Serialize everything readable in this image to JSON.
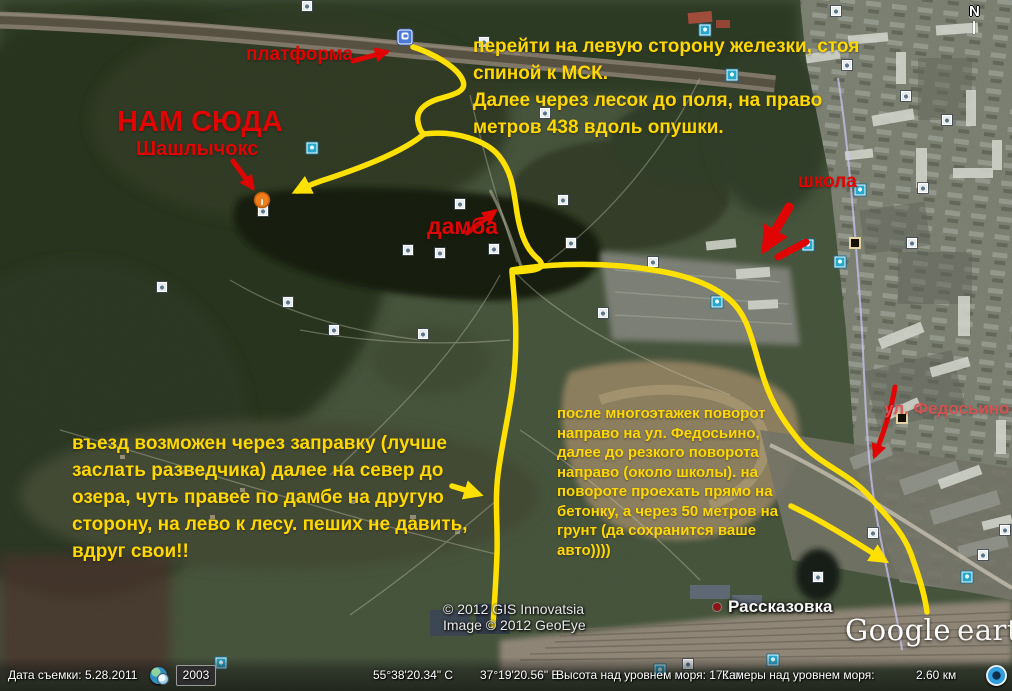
{
  "app": {
    "logo_google": "Google",
    "logo_earth": "earth",
    "compass_label": "N"
  },
  "annotations": {
    "platform_label": "платформа",
    "nam_suda": "НАМ СЮДА",
    "shashlychoks": "Шашлычокс",
    "damba": "дамба",
    "shkola": "школа",
    "fedosino": "ул. Федосьино",
    "note_top": {
      "lines": [
        "перейти на левую сторону железки, стоя",
        "спиной к МСК.",
        "Далее через лесок до поля, на право",
        "метров 438 вдоль опушки."
      ]
    },
    "note_left": {
      "lines": [
        "въезд возможен через заправку (лучше",
        "заслать разведчика) далее на север до",
        "озера, чуть правее по дамбе на другую",
        "сторону, на лево к лесу. пеших не давить,",
        "вдруг свои!!"
      ]
    },
    "note_center": {
      "lines": [
        "после многоэтажек поворот",
        "направо на ул. Федосьино,",
        "далее до резкого поворота",
        "направо (около школы). на",
        "повороте проехать прямо на",
        "бетонку, а через 50 метров на",
        "грунт (да сохранится ваше",
        "авто))))"
      ]
    }
  },
  "map_labels": {
    "place": "Рассказовка",
    "copyright_line1": "© 2012 GIS Innovatsia",
    "copyright_line2": "Image © 2012 GeoEye"
  },
  "status_bar": {
    "imagery_date": "Дата съемки: 5.28.2011",
    "time_slider_year": "2003",
    "latitude": "55°38'20.34\" С",
    "longitude": "37°19'20.56\" В",
    "elevation": "Высота над уровнем моря: 172 м",
    "camera_altitude_label": "Камеры над уровнем моря:",
    "camera_altitude_value": "2.60 км"
  },
  "colors": {
    "route_yellow": "#ffe100",
    "annotation_yellow": "#ffd800",
    "annotation_red": "#e00404",
    "marker_orange": "#ef7d1a"
  },
  "map_icons": [
    {
      "name": "photo-icon",
      "type": "photo",
      "x": 307,
      "y": 6
    },
    {
      "name": "photo-icon",
      "type": "photo",
      "x": 836,
      "y": 11
    },
    {
      "name": "railway-station-icon",
      "type": "train",
      "x": 405,
      "y": 37
    },
    {
      "name": "photo-icon",
      "type": "photo",
      "x": 484,
      "y": 42
    },
    {
      "name": "panoramio-icon",
      "type": "pano",
      "x": 705,
      "y": 30
    },
    {
      "name": "panoramio-icon",
      "type": "pano",
      "x": 732,
      "y": 75
    },
    {
      "name": "photo-icon",
      "type": "photo",
      "x": 847,
      "y": 65
    },
    {
      "name": "photo-icon",
      "type": "photo",
      "x": 906,
      "y": 96
    },
    {
      "name": "photo-icon",
      "type": "photo",
      "x": 947,
      "y": 120
    },
    {
      "name": "photo-icon",
      "type": "photo",
      "x": 545,
      "y": 113
    },
    {
      "name": "panoramio-icon",
      "type": "pano",
      "x": 312,
      "y": 148
    },
    {
      "name": "photo-icon",
      "type": "photo",
      "x": 460,
      "y": 204
    },
    {
      "name": "photo-icon",
      "type": "photo",
      "x": 563,
      "y": 200
    },
    {
      "name": "panoramio-icon",
      "type": "pano",
      "x": 860,
      "y": 190
    },
    {
      "name": "photo-icon",
      "type": "photo",
      "x": 923,
      "y": 188
    },
    {
      "name": "photo-icon",
      "type": "photo",
      "x": 263,
      "y": 211
    },
    {
      "name": "photo-icon",
      "type": "photo",
      "x": 408,
      "y": 250
    },
    {
      "name": "photo-icon",
      "type": "photo",
      "x": 440,
      "y": 253
    },
    {
      "name": "photo-icon",
      "type": "photo",
      "x": 494,
      "y": 249
    },
    {
      "name": "photo-icon",
      "type": "photo",
      "x": 571,
      "y": 243
    },
    {
      "name": "placemark-icon",
      "type": "special",
      "x": 855,
      "y": 243
    },
    {
      "name": "panoramio-icon",
      "type": "pano",
      "x": 808,
      "y": 245
    },
    {
      "name": "panoramio-icon",
      "type": "pano",
      "x": 840,
      "y": 262
    },
    {
      "name": "photo-icon",
      "type": "photo",
      "x": 912,
      "y": 243
    },
    {
      "name": "photo-icon",
      "type": "photo",
      "x": 162,
      "y": 287
    },
    {
      "name": "photo-icon",
      "type": "photo",
      "x": 288,
      "y": 302
    },
    {
      "name": "panoramio-icon",
      "type": "pano",
      "x": 717,
      "y": 302
    },
    {
      "name": "photo-icon",
      "type": "photo",
      "x": 653,
      "y": 262
    },
    {
      "name": "photo-icon",
      "type": "photo",
      "x": 334,
      "y": 330
    },
    {
      "name": "photo-icon",
      "type": "photo",
      "x": 423,
      "y": 334
    },
    {
      "name": "photo-icon",
      "type": "photo",
      "x": 603,
      "y": 313
    },
    {
      "name": "placemark-icon",
      "type": "special",
      "x": 902,
      "y": 418
    },
    {
      "name": "photo-icon",
      "type": "photo",
      "x": 873,
      "y": 533
    },
    {
      "name": "photo-icon",
      "type": "photo",
      "x": 983,
      "y": 555
    },
    {
      "name": "panoramio-icon",
      "type": "pano",
      "x": 967,
      "y": 577
    },
    {
      "name": "photo-icon",
      "type": "photo",
      "x": 818,
      "y": 577
    },
    {
      "name": "photo-icon",
      "type": "photo",
      "x": 1005,
      "y": 530
    },
    {
      "name": "panoramio-icon",
      "type": "pano",
      "x": 221,
      "y": 663
    },
    {
      "name": "panoramio-icon",
      "type": "pano",
      "x": 660,
      "y": 670
    },
    {
      "name": "photo-icon",
      "type": "photo",
      "x": 688,
      "y": 664
    },
    {
      "name": "panoramio-icon",
      "type": "pano",
      "x": 773,
      "y": 660
    }
  ]
}
